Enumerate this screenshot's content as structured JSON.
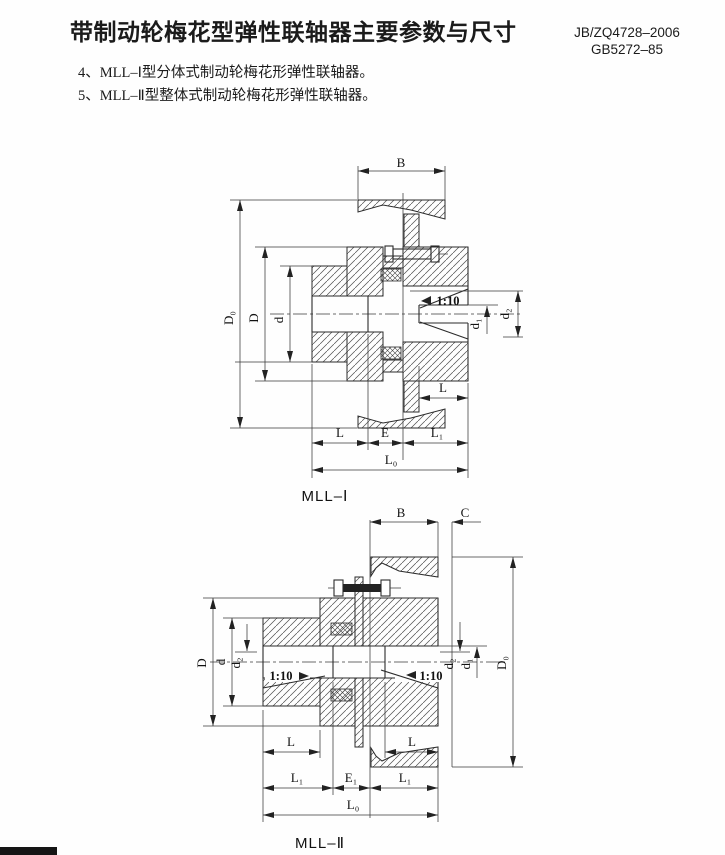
{
  "header": {
    "title": "带制动轮梅花型弹性联轴器主要参数与尺寸",
    "standard_line1": "JB/ZQ4728–2006",
    "standard_line2": "GB5272–85"
  },
  "notes": {
    "item_1": "4、MLL–Ⅰ型分体式制动轮梅花形弹性联轴器。",
    "item_2": "5、MLL–Ⅱ型整体式制动轮梅花形弹性联轴器。"
  },
  "figure1": {
    "caption": "MLL–Ⅰ",
    "dims": {
      "B": "B",
      "D0": "D₀",
      "D": "D",
      "d": "d",
      "taper": "1:10",
      "d1": "d₁",
      "d2": "d₂",
      "L_hole": "L",
      "L": "L",
      "E": "E",
      "L1": "L₁",
      "L0": "L₀"
    }
  },
  "figure2": {
    "caption": "MLL–Ⅱ",
    "dims": {
      "B": "B",
      "C": "C",
      "D": "D",
      "d": "d",
      "d2_left": "d₂",
      "taper_left": "1:10",
      "taper_right": "1:10",
      "d2_right": "d₂",
      "d1": "d₁",
      "D0": "D₀",
      "L_left": "L",
      "L_right": "L",
      "L1_left": "L₁",
      "E1": "E₁",
      "L1_right": "L₁",
      "L0": "L₀"
    }
  }
}
